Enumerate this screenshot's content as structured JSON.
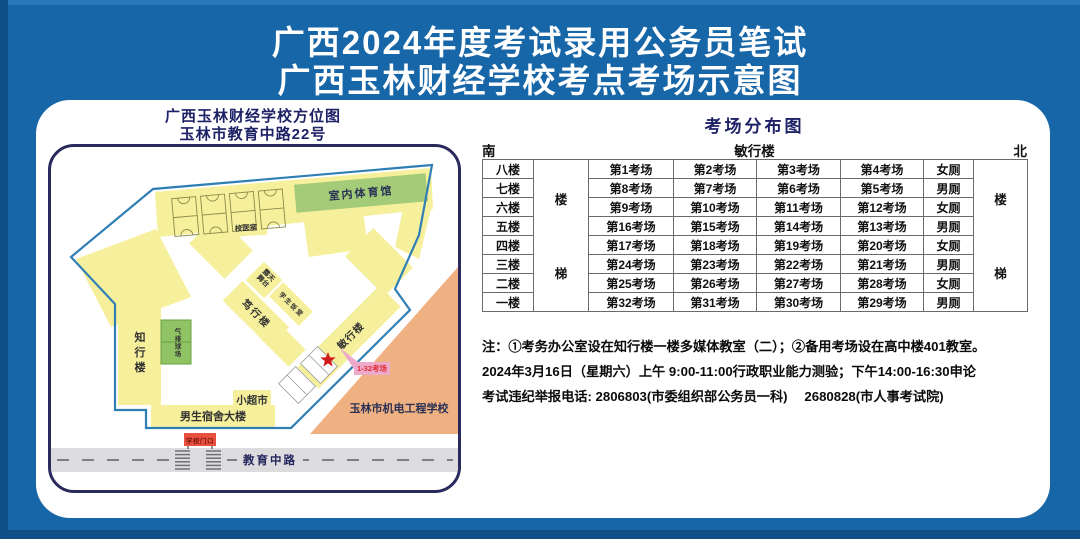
{
  "page_title": {
    "line1": "广西2024年度考试录用公务员笔试",
    "line2": "广西玉林财经学校考点考场示意图"
  },
  "map": {
    "title_line1": "广西玉林财经学校方位图",
    "title_line2": "玉林市教育中路22号",
    "buildings": {
      "gym": "室内体育馆",
      "clinic": "校医室",
      "stage": "露天舞台",
      "canteen": "学生饭堂",
      "duxing": "笃行楼",
      "minxing": "敏行楼",
      "zhixing": "知行楼",
      "volleyball": "气排球场",
      "supermarket": "小超市",
      "dorm": "男生宿舍大楼",
      "gate": "学校门口",
      "neighbor_school": "玉林市机电工程学校",
      "road": "教育中路",
      "exam_rooms_callout": "1-32考场"
    }
  },
  "exam_table": {
    "title": "考场分布图",
    "south": "南",
    "building": "敏行楼",
    "north": "北",
    "stairs": {
      "top": "楼",
      "bottom": "梯"
    },
    "rows": [
      {
        "floor": "八楼",
        "rooms": [
          "第1考场",
          "第2考场",
          "第3考场",
          "第4考场"
        ],
        "toilet": "女厕"
      },
      {
        "floor": "七楼",
        "rooms": [
          "第8考场",
          "第7考场",
          "第6考场",
          "第5考场"
        ],
        "toilet": "男厕"
      },
      {
        "floor": "六楼",
        "rooms": [
          "第9考场",
          "第10考场",
          "第11考场",
          "第12考场"
        ],
        "toilet": "女厕"
      },
      {
        "floor": "五楼",
        "rooms": [
          "第16考场",
          "第15考场",
          "第14考场",
          "第13考场"
        ],
        "toilet": "男厕"
      },
      {
        "floor": "四楼",
        "rooms": [
          "第17考场",
          "第18考场",
          "第19考场",
          "第20考场"
        ],
        "toilet": "女厕"
      },
      {
        "floor": "三楼",
        "rooms": [
          "第24考场",
          "第23考场",
          "第22考场",
          "第21考场"
        ],
        "toilet": "男厕"
      },
      {
        "floor": "二楼",
        "rooms": [
          "第25考场",
          "第26考场",
          "第27考场",
          "第28考场"
        ],
        "toilet": "女厕"
      },
      {
        "floor": "一楼",
        "rooms": [
          "第32考场",
          "第31考场",
          "第30考场",
          "第29考场"
        ],
        "toilet": "男厕"
      }
    ]
  },
  "notes": [
    "注：①考务办公室设在知行楼一楼多媒体教室（二）；②备用考场设在高中楼401教室。",
    "2024年3月16日（星期六）上午 9:00-11:00行政职业能力测验；下午14:00-16:30申论",
    "考试违纪举报电话: 2806803(市委组织部公务员一科)　 2680828(市人事考试院)"
  ],
  "colors": {
    "background_blue": "#1766a8",
    "heading_navy": "#1d2166",
    "building_yellow": "#f6f09c",
    "gym_green": "#a4cb78",
    "neighbor_orange": "#f0b182",
    "gate_red": "#e8503f",
    "star_red": "#cf1b1b",
    "callout_pink": "#eeaacb"
  }
}
